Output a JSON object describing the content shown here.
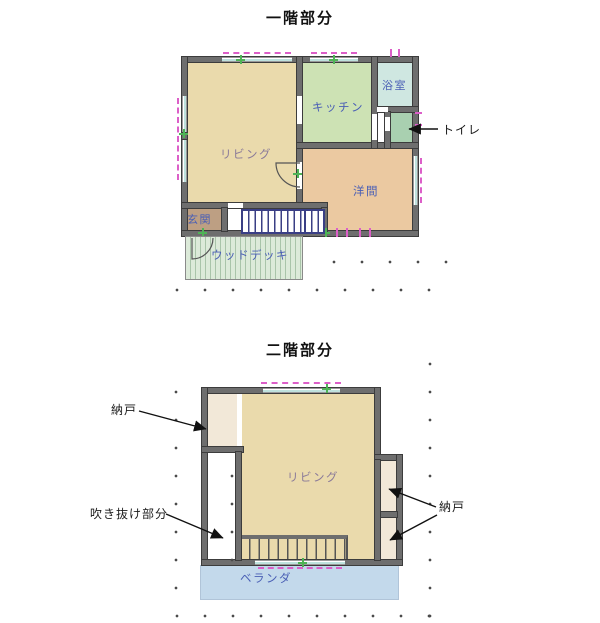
{
  "floor1": {
    "title": "一階部分",
    "rooms": {
      "living": {
        "label": "リビング",
        "color": "#EADAAC"
      },
      "kitchen": {
        "label": "キッチン",
        "color": "#CDE2B4"
      },
      "bath": {
        "label": "浴室",
        "color": "#CFE7E1"
      },
      "toilet": {
        "label": "トイレ",
        "color": "#A9D0B0"
      },
      "western_room": {
        "label": "洋間",
        "color": "#EBC9A1"
      },
      "entrance": {
        "label": "玄関",
        "color": "#BD9F83"
      },
      "wood_deck": {
        "label": "ウッドデッキ",
        "color": "#DCE9DA"
      }
    }
  },
  "floor2": {
    "title": "二階部分",
    "rooms": {
      "living": {
        "label": "リビング",
        "color": "#EADAAC"
      },
      "storage_top_left": {
        "label": "納戸",
        "color": "#F2E8D8"
      },
      "storage_right": {
        "label": "納戸",
        "color": "#F2E8D8"
      },
      "void_area": {
        "label": "吹き抜け部分",
        "color": "#FFFFFF"
      },
      "veranda": {
        "label": "ベランダ",
        "color": "#C3D9EB"
      }
    }
  },
  "palette": {
    "wall": "#6E6E6E",
    "stair_outline": "#3A3F85",
    "window_cyan": "#BFE2DE",
    "curtain_magenta": "#DC5FC8",
    "tick_green": "#4FB356",
    "room_label_blue": "#4A5FB5",
    "living_label_purple": "#8A7A99",
    "annotation_black": "#1A1A1A"
  }
}
